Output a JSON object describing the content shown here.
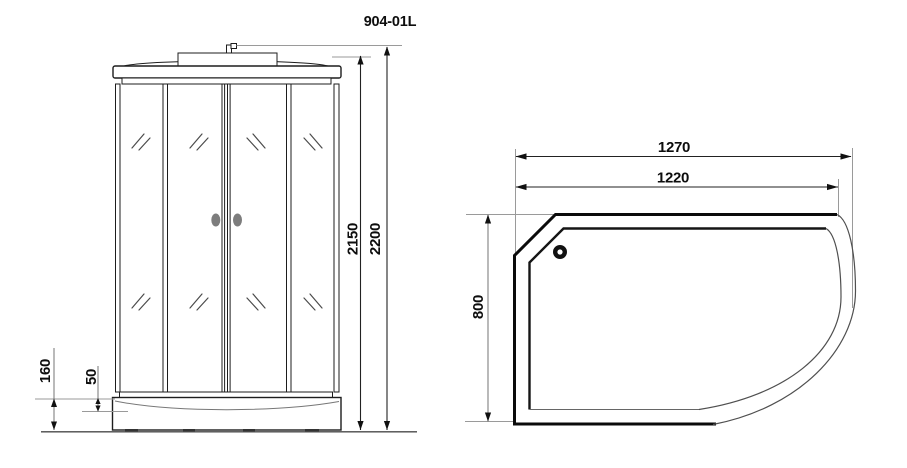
{
  "title": "904-01L",
  "front_view": {
    "dims": {
      "overall_height": "2200",
      "cabin_height": "2150",
      "tray_height": "160",
      "tray_lip": "50"
    }
  },
  "plan_view": {
    "dims": {
      "overall_width": "1270",
      "inner_width": "1220",
      "depth": "800"
    }
  },
  "colors": {
    "line": "#1d1d1d",
    "thick_line": "#0b0b0b",
    "extension_line": "#9a9a9a",
    "handle": "#7d7d7d",
    "background": "#ffffff"
  }
}
